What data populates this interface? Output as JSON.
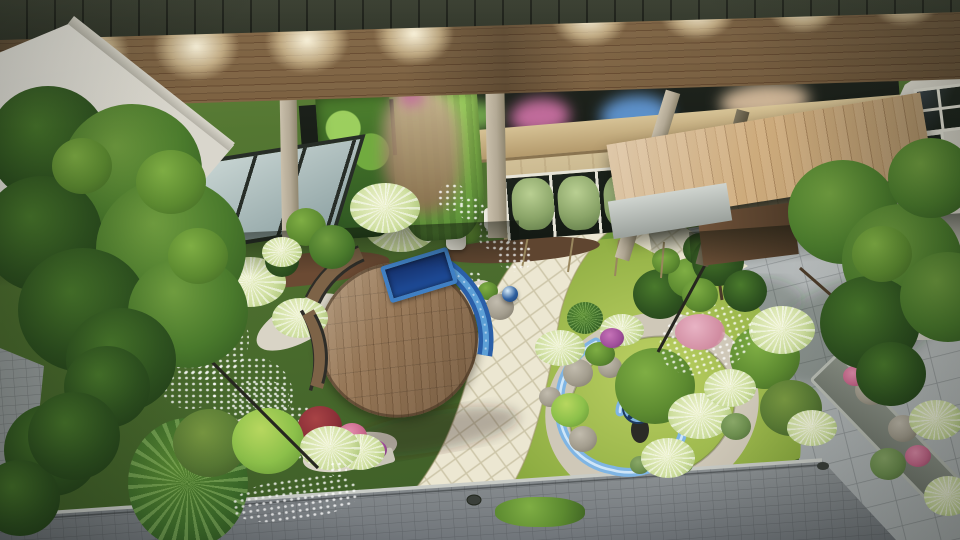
{
  "meta": {
    "domain": "Natural-Image",
    "type": "3d-architectural-landscape-render",
    "view": "aerial-oblique",
    "lighting": "dusk-with-canopy-downlights"
  },
  "scene": {
    "description": "Aerial 3D rendering of a modern courtyard garden at dusk: a building with a wooden slat canopy and recessed downlights across the top, vertical green walls, a glazed skylight, a timber entrance canopy by a white house; below, a circular wooden deck with curved benches and a blue mosaic water channel, beds of burgundy groundcover, silver grasses and topiary, a cream paver path curving past a round lawn island with a gravel ring, stone spheres and a light-blue spiral sculpture around a reflective orb, a large grey stone plaza with trees and a planted strip, and a grey walkway across the bottom",
    "architecture": [
      "dark-roof-band",
      "wood-slat-canopy",
      "recessed-downlights",
      "concrete-pillars",
      "diagonal-struts",
      "vertical-green-walls",
      "glazed-skylight",
      "beige-stone-wall",
      "window-row-with-hedges",
      "timber-entrance-canopy",
      "white-house-left",
      "white-house-right"
    ],
    "garden": [
      "circular-wood-deck",
      "curved-benches",
      "blue-mosaic-water-band",
      "blue-tile-planter",
      "topiary-balls",
      "silver-grasses",
      "burgundy-groundcover",
      "white-gravel",
      "stepping-stones",
      "leaning-lamp-posts",
      "cream-paver-path",
      "lawn-island",
      "gravel-ring",
      "stone-spheres",
      "spiral-ribbon-sculpture",
      "reflective-orb",
      "azalea-shrub",
      "boxwood-balls",
      "variegated-hedge",
      "large-left-tree",
      "plaza-trees",
      "planted-strip",
      "grey-plaza-pavers",
      "bottom-walkway",
      "drain-caps"
    ]
  },
  "palette": {
    "roofDark": "#23281f",
    "canopyWood": "#7e6343",
    "canopyWoodDark": "#6b5136",
    "lightCone": "#fff6dc",
    "concreteHi": "#c9bfab",
    "concrete": "#b3a995",
    "concreteLo": "#8f866f",
    "skylightGlass": "#c7d4d2",
    "frameDark": "#272d27",
    "greenWallDark": "#2e5522",
    "greenWallMid": "#4c7f2c",
    "greenWallLight": "#9ccf5e",
    "beigeWall": "#cdb887",
    "windowDark": "#1c231c",
    "windowFrame": "#e6e4d8",
    "hedgeGreenHi": "#b9cf92",
    "hedgeGreen": "#8aa468",
    "hedgeGreenLo": "#5f7a47",
    "tanBeam": "#d6c295",
    "tanBeamDark": "#b49a6c",
    "lightWood": "#cdab7c",
    "lightWoodDark": "#c09c6e",
    "entranceDark": "#191e18",
    "brownWall": "#6e5138",
    "whiteBldg": "#eceade",
    "whiteBldgShade": "#c9c6bb",
    "gardenBase": "#55742f",
    "gardenBaseDark": "#3f5f28",
    "lawnBright": "#bcd063",
    "lawnMid": "#8fae43",
    "lawnDark": "#79992f",
    "pathCream": "#ece7d2",
    "pathGrout": "#cdc6a9",
    "plazaLight": "#c6cac9",
    "plazaDark": "#9ba1a3",
    "walkGray": "#8f9496",
    "walkGrayDark": "#7c8184",
    "edgeSilver": "#c8cbc6",
    "deckWood": "#957656",
    "deckWoodDark": "#7f6245",
    "benchWood": "#7d6347",
    "benchFrame": "#2e2d28",
    "waterBlueDeep": "#1f4f9e",
    "waterBlue": "#3f7fc4",
    "waterBlueLight": "#5c9fd6",
    "spiralBlue": "#7fb5e4",
    "spiralBlueLight": "#cfe6f8",
    "orbBlue": "#2e5f9e",
    "gravelWhite": "#d9d4c6",
    "gravelRing": "#cfc8b8",
    "stoneHi": "#c2bcae",
    "stone": "#a39d8e",
    "stoneLo": "#7b7567",
    "treeHi": "#6f9c3f",
    "tree": "#4a7a2c",
    "treeDark": "#2f5420",
    "treeDeep": "#1f3a17",
    "shrubHi": "#7fae44",
    "shrub": "#5c8a30",
    "shrubLo": "#3f6424",
    "limeHi": "#b7d75f",
    "lime": "#8cc04a",
    "limeLo": "#5f8f33",
    "oliveHi": "#7a9a42",
    "olive": "#5a7c35",
    "oliveLo": "#3d5826",
    "paleHi": "#eef2cf",
    "pale": "#cfdfa0",
    "paleLo": "#9fbb6a",
    "fluffHi": "#5d8f35",
    "fluff": "#3f6f2b",
    "fluffLo": "#2a4e1e",
    "hedgeVarHi": "#cdd9a8",
    "hedgeVar": "#a8bc7e",
    "hedgeVarLo": "#7e9158",
    "boxHi": "#8aa868",
    "box": "#6d8f4f",
    "boxLo": "#4f6b38",
    "burgHi": "#a84345",
    "burg": "#8c3038",
    "burgLo": "#5f1f28",
    "burgDeep": "#3d151b",
    "pinkHi": "#e58fae",
    "pink": "#c9688c",
    "pinkLo": "#9c4a6a",
    "azaleaHi": "#d98ba0",
    "azalea": "#b55a74",
    "azaleaLo": "#8a3f56",
    "magentaHi": "#c673b8",
    "magenta": "#a04f9a",
    "magentaLo": "#6f3570",
    "whiteFlHi": "#f3f5ea",
    "whiteFl": "#dfe6cc",
    "whiteFlLo": "#b8c49a",
    "mulch": "#6b4a33",
    "trunk": "#4a3a28",
    "lampBlack": "#26261f",
    "blurTan": "#cbb294",
    "blurPink": "#c06a9a",
    "blurBlue": "#5b8fc9",
    "blurGreen": "#6fa34a"
  }
}
